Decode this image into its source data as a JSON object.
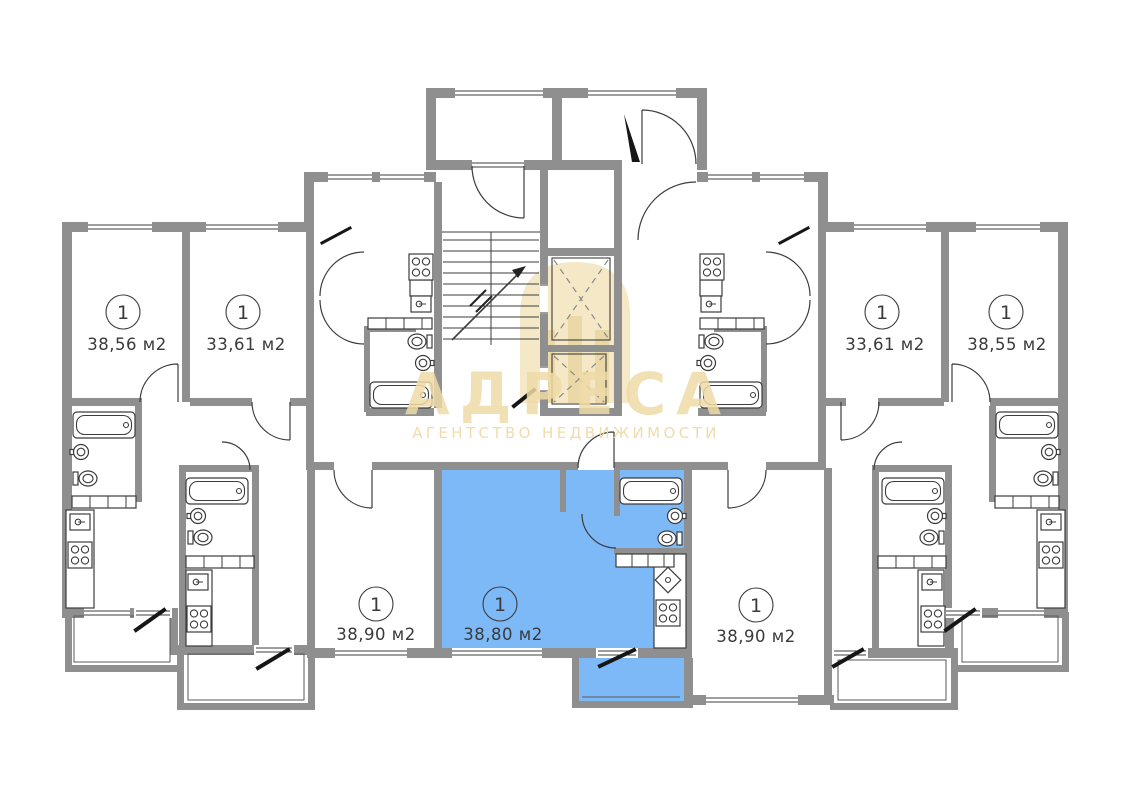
{
  "plan": {
    "apartments": [
      {
        "unit": "1",
        "area": "38,56 м2",
        "position": "top-left",
        "highlighted": false
      },
      {
        "unit": "1",
        "area": "33,61 м2",
        "position": "top-left-2",
        "highlighted": false
      },
      {
        "unit": "1",
        "area": "33,61 м2",
        "position": "top-right-2",
        "highlighted": false
      },
      {
        "unit": "1",
        "area": "38,55 м2",
        "position": "top-right",
        "highlighted": false
      },
      {
        "unit": "1",
        "area": "38,90 м2",
        "position": "bottom-left",
        "highlighted": false
      },
      {
        "unit": "1",
        "area": "38,80 м2",
        "position": "bottom-center",
        "highlighted": true
      },
      {
        "unit": "1",
        "area": "38,90 м2",
        "position": "bottom-right",
        "highlighted": false
      }
    ],
    "watermark": {
      "title": "АДРЕСА",
      "subtitle": "АГЕНТСТВО НЕДВИЖИМОСТИ"
    },
    "colors": {
      "wall": "#8f8f8f",
      "line": "#3c3c3c",
      "highlight": "#7db9f7",
      "watermark": "#efdba6",
      "background": "#ffffff"
    }
  }
}
